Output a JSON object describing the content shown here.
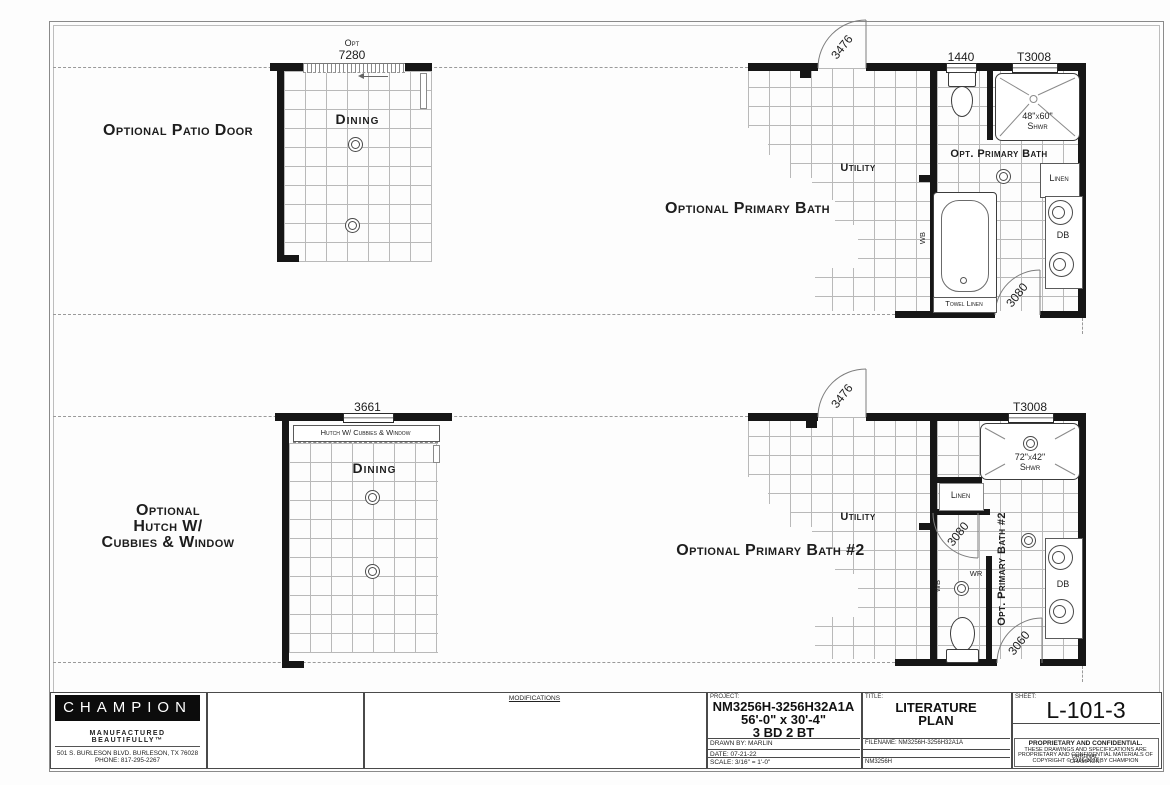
{
  "plan_top": {
    "patio_label": "Optional Patio Door",
    "dining": {
      "name": "Dining",
      "dim_opt": "Opt",
      "dim": "7280"
    },
    "bath": {
      "title": "Optional Primary Bath",
      "door_entry": "3476",
      "window_wc": "1440",
      "window_shower": "T3008",
      "shower_size": "48\"x60\"",
      "shower_abbr": "Shwr",
      "room": "Opt. Primary Bath",
      "utility": "Utility",
      "linen": "Linen",
      "vanity": "DB",
      "wb": "WB",
      "towel_linen": "Towel Linen",
      "door_hall": "3080"
    }
  },
  "plan_bottom": {
    "hutch_label_1": "Optional",
    "hutch_label_2": "Hutch W/",
    "hutch_label_3": "Cubbies & Window",
    "dining": {
      "name": "Dining",
      "dim": "3661",
      "hutch": "Hutch W/ Cubbies & Window"
    },
    "bath": {
      "title": "Optional Primary Bath #2",
      "door_entry": "3476",
      "window_shower": "T3008",
      "shower_size": "72\"x42\"",
      "shower_abbr": "Shwr",
      "room_vertical": "Opt. Primary Bath #2",
      "utility": "Utility",
      "linen": "Linen",
      "vanity": "DB",
      "wb": "WB",
      "wr": "WR",
      "door_wc": "3080",
      "door_hall": "3060"
    }
  },
  "title_block": {
    "brand": {
      "name": "CHAMPION",
      "tagline": "MANUFACTURED BEAUTIFULLY™",
      "address": "501 S. BURLESON BLVD.  BURLESON, TX  76028",
      "phone": "PHONE: 817-295-2267"
    },
    "modifications_header": "MODIFICATIONS",
    "project": {
      "label": "PROJECT:",
      "model": "NM3256H-3256H32A1A",
      "size": "56'-0\" x 30'-4\"",
      "beds": "3 BD 2 BT",
      "drawn_by": "DRAWN BY: MARLIN",
      "date": "DATE: 07-21-22",
      "scale": "SCALE: 3/16\" = 1'-0\""
    },
    "title": {
      "label": "TITLE:",
      "line1": "LITERATURE",
      "line2": "PLAN",
      "filename": "FILENAME: NM3256H-3256H32A1A",
      "model": "NM3256H"
    },
    "sheet": {
      "label": "SHEET:",
      "number": "L-101-3",
      "legal_title": "PROPRIETARY AND CONFIDENTIAL.",
      "legal_line1": "THESE DRAWINGS AND SPECIFICATIONS ARE ORIGINAL,",
      "legal_line2": "PROPRIETARY AND CONFIDENTIAL MATERIALS OF CHAMPION.",
      "copyright": "COPYRIGHT © 1976-2022 BY CHAMPION"
    }
  }
}
